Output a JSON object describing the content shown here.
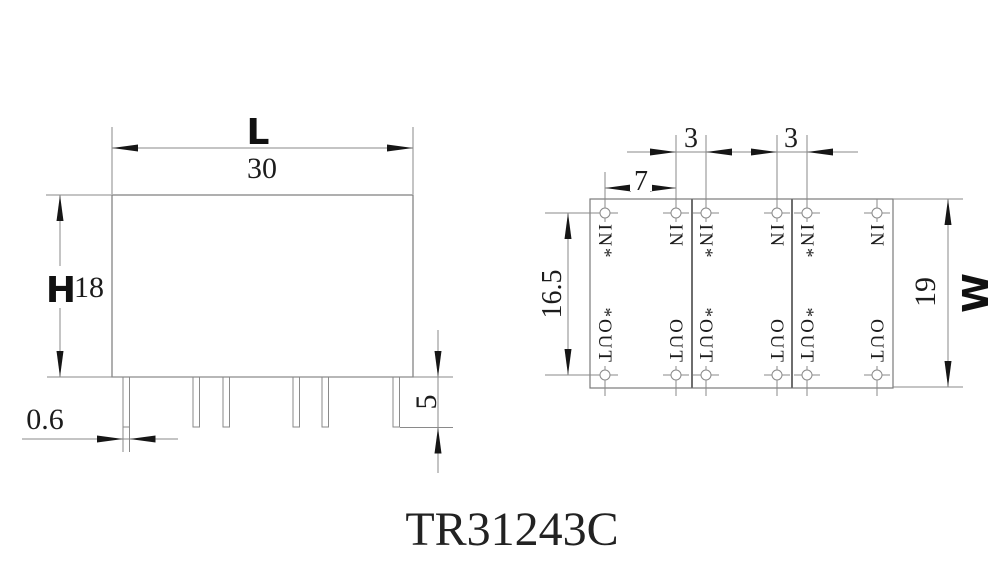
{
  "title": "TR31243C",
  "front_view": {
    "length": {
      "label": "L",
      "value": "30"
    },
    "height": {
      "label": "H",
      "value": "18"
    },
    "pin_width": {
      "value": "0.6"
    },
    "pin_length": {
      "value": "5"
    }
  },
  "top_view": {
    "pin_spacing_outer": {
      "value": "7"
    },
    "gap_left": {
      "value": "3"
    },
    "gap_right": {
      "value": "3"
    },
    "pin_row_span": {
      "value": "16.5"
    },
    "width": {
      "label": "W",
      "value": "19"
    },
    "columns": [
      {
        "top": "IN*",
        "bottom": "*OUT"
      },
      {
        "top": "IN",
        "bottom": "OUT"
      },
      {
        "top": "IN*",
        "bottom": "*OUT"
      },
      {
        "top": "IN",
        "bottom": "OUT"
      },
      {
        "top": "IN*",
        "bottom": "*OUT"
      },
      {
        "top": "IN",
        "bottom": "OUT"
      }
    ]
  }
}
